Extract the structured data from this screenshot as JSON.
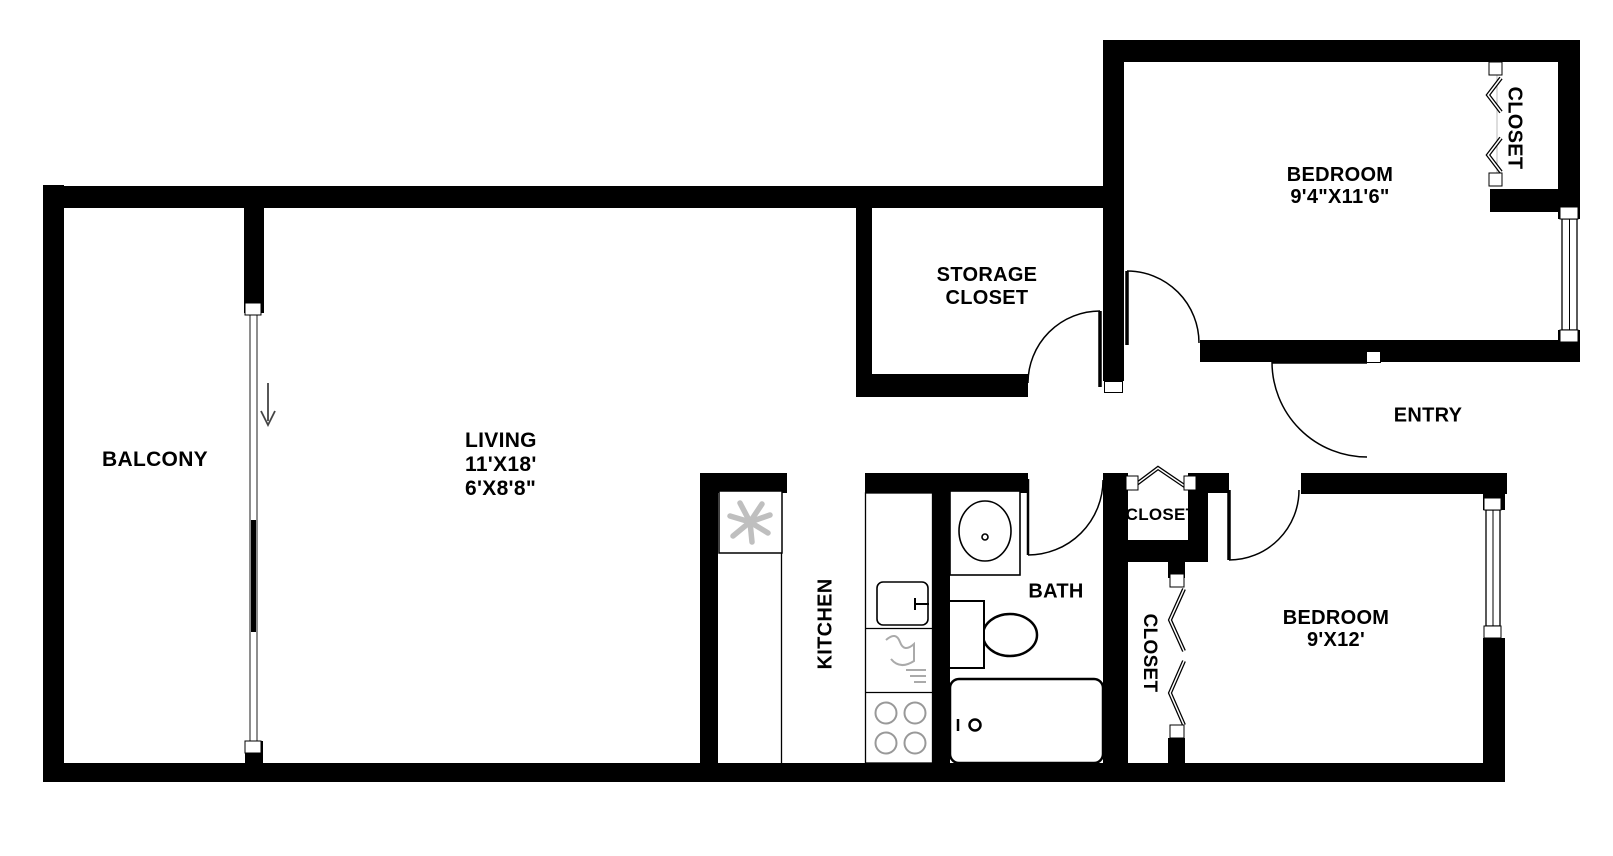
{
  "floorplan": {
    "rooms": {
      "balcony": {
        "label": "BALCONY"
      },
      "living": {
        "label": "LIVING",
        "dims": [
          "11'X18'",
          "6'X8'8\""
        ]
      },
      "storage_closet": {
        "lines": [
          "STORAGE",
          "CLOSET"
        ]
      },
      "bedroom1": {
        "label": "BEDROOM",
        "dims": "9'4\"X11'6\""
      },
      "bedroom1_closet": {
        "label": "CLOSET"
      },
      "entry": {
        "label": "ENTRY"
      },
      "hall_closet": {
        "label": "CLOSET"
      },
      "bedroom2_closet": {
        "label": "CLOSET"
      },
      "kitchen": {
        "label": "KITCHEN"
      },
      "bath": {
        "label": "BATH"
      },
      "bedroom2": {
        "label": "BEDROOM",
        "dims": "9'X12'"
      }
    },
    "fixtures": [
      "fan",
      "kitchen-sink",
      "dishwasher",
      "stove-burners",
      "vanity-sink",
      "toilet",
      "bathtub",
      "sliding-glass-door",
      "down-arrow"
    ],
    "colors": {
      "wall": "#000000",
      "background": "#ffffff",
      "fixture_stroke": "#aaaaaa"
    }
  }
}
